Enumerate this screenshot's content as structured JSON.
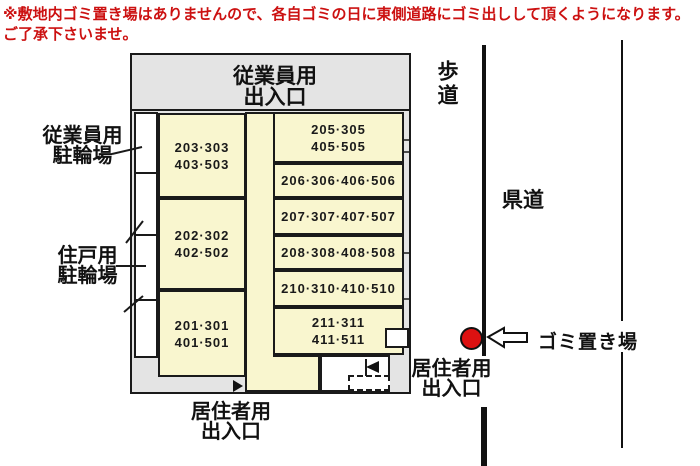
{
  "notice": {
    "line1": "※敷地内ゴミ置き場はありませんので、各自ゴミの日に東側道路にゴミ出しして頂くようになります。",
    "line2": "ご了承下さいませ。"
  },
  "building": {
    "employee_entrance": {
      "line1": "従業員用",
      "line2": "出入口"
    },
    "left_rooms": [
      {
        "line1": "203·303",
        "line2": "403·503"
      },
      {
        "line1": "202·302",
        "line2": "402·502"
      },
      {
        "line1": "201·301",
        "line2": "401·501"
      }
    ],
    "right_rooms": [
      {
        "line1": "205·305",
        "line2": "405·505"
      },
      {
        "line1": "206·306·406·506"
      },
      {
        "line1": "207·307·407·507"
      },
      {
        "line1": "208·308·408·508"
      },
      {
        "line1": "210·310·410·510"
      },
      {
        "line1": "211·311",
        "line2": "411·511"
      }
    ]
  },
  "labels": {
    "employee_bicycle_parking": {
      "line1": "従業員用",
      "line2": "駐輪場"
    },
    "resident_bicycle_parking": {
      "line1": "住戸用",
      "line2": "駐輪場"
    },
    "resident_entrance_bottom": {
      "line1": "居住者用",
      "line2": "出入口"
    },
    "resident_entrance_right": {
      "line1": "居住者用",
      "line2": "出入口"
    },
    "sidewalk": "歩道",
    "prefectural_road": "県道",
    "garbage_site": "ゴミ置き場"
  },
  "colors": {
    "notice_red": "#cc1111",
    "marker_red": "#dd1111",
    "room_yellow": "#f9f6cf",
    "area_gray": "#e4e4e4"
  }
}
